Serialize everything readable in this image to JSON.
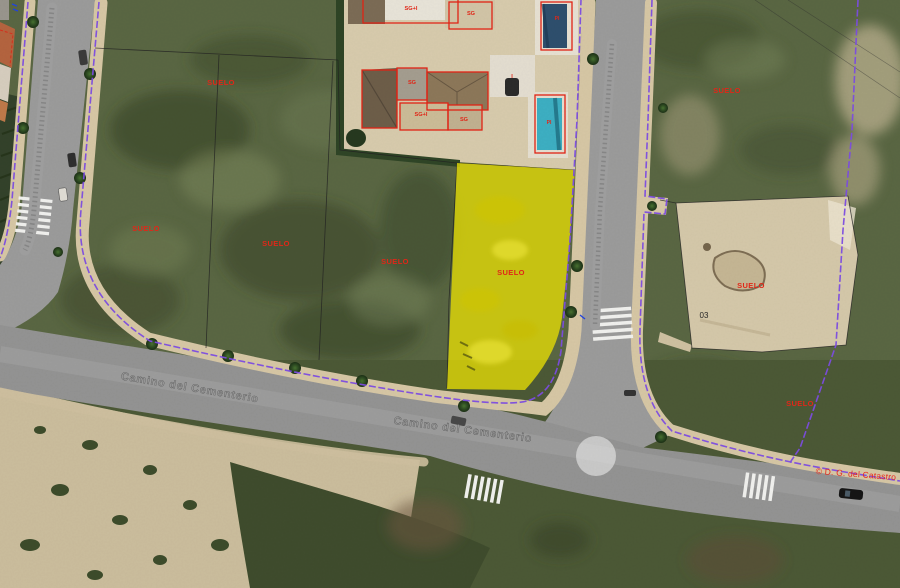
{
  "map": {
    "attribution": {
      "copyright": "© D. G. del Catastro"
    },
    "streets": {
      "bottom_road_name": "Camino del Cementerio"
    },
    "labels": {
      "suelo": "SUELO",
      "pool": "PI",
      "sg": "SG",
      "sg_plus_one": "SG+I",
      "i_marker": "I",
      "parcel_number": "03"
    },
    "highlighted_parcel": {
      "label": "SUELO",
      "fill": "#e6dc05",
      "outline": "#7c4ce0"
    },
    "colors": {
      "cadastral_boundary": "#7c4ce0",
      "building_outline": "#e02314",
      "parcel_label_red": "#e02718",
      "road_asphalt": "#9a9a9a",
      "sidewalk": "#d8c8a6",
      "scrub_green": "#5a6743",
      "bare_sand": "#d6c9ab",
      "pool_dark_blue": "#2e4f6e",
      "pool_teal": "#3db0c4"
    }
  }
}
